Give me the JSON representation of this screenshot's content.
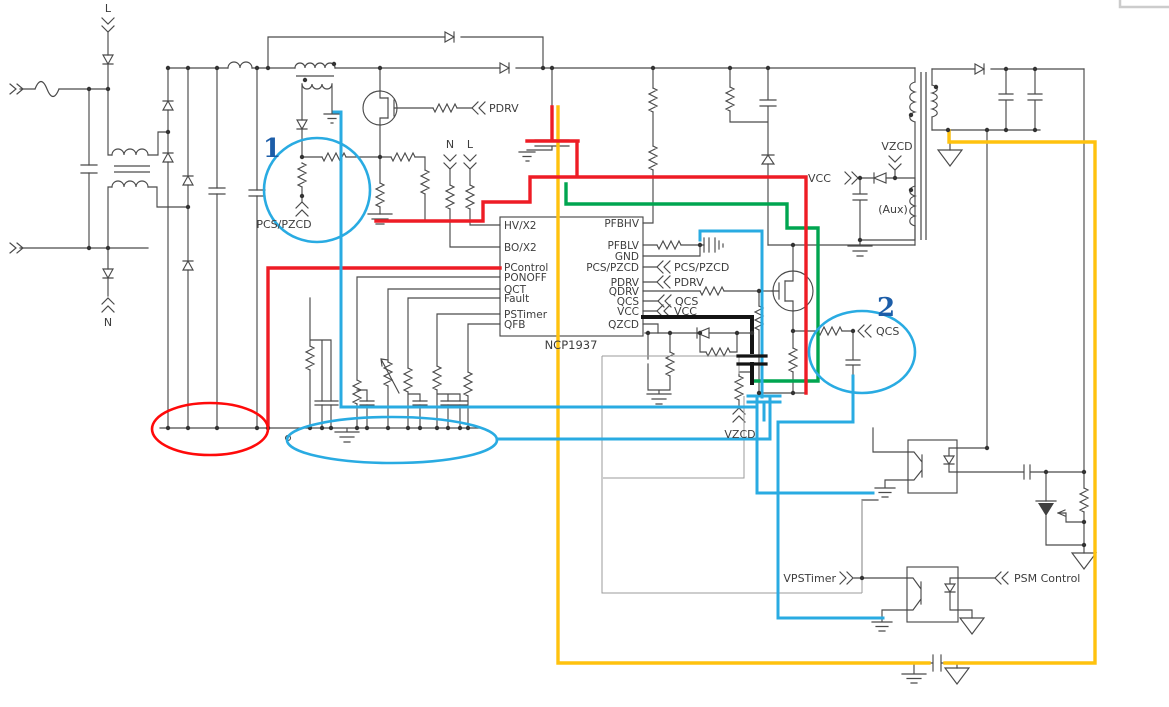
{
  "diagram": {
    "type": "circuit-schematic",
    "ic": {
      "part": "NCP1937",
      "pins_left": [
        "HV/X2",
        "BO/X2",
        "PControl",
        "PONOFF",
        "QCT",
        "Fault",
        "PSTimer",
        "QFB"
      ],
      "pins_right": [
        "PFBHV",
        "PFBLV",
        "GND",
        "PCS/PZCD",
        "PDRV",
        "QDRV",
        "QCS",
        "VCC",
        "QZCD"
      ]
    },
    "labels": {
      "line_input": "L",
      "neutral_input": "N",
      "pdrv_pfc": "PDRV",
      "pcs_pzcd_pfc": "PCS/PZCD",
      "neutral_sense": "N",
      "line_sense": "L",
      "pcs_pzcd_send": "PCS/PZCD",
      "pdrv_send": "PDRV",
      "qcs_send": "QCS",
      "vcc_send": "VCC",
      "vcc_aux": "VCC",
      "vzcd_aux": "VZCD",
      "aux_winding": "(Aux)",
      "qcs_sense": "QCS",
      "vzcd_divider": "VZCD",
      "vpstimer": "VPSTimer",
      "psm_control": "PSM Control"
    },
    "annotations": {
      "marker_1": "1",
      "marker_2": "2"
    },
    "colors": {
      "trace_red": "#ee1c25",
      "trace_green": "#00a550",
      "trace_cyan": "#29abe2",
      "trace_yellow": "#ffc20e",
      "trace_black": "#141414",
      "annotation_blue": "#1c5da8",
      "schematic_gray": "#4a4a4a"
    }
  }
}
